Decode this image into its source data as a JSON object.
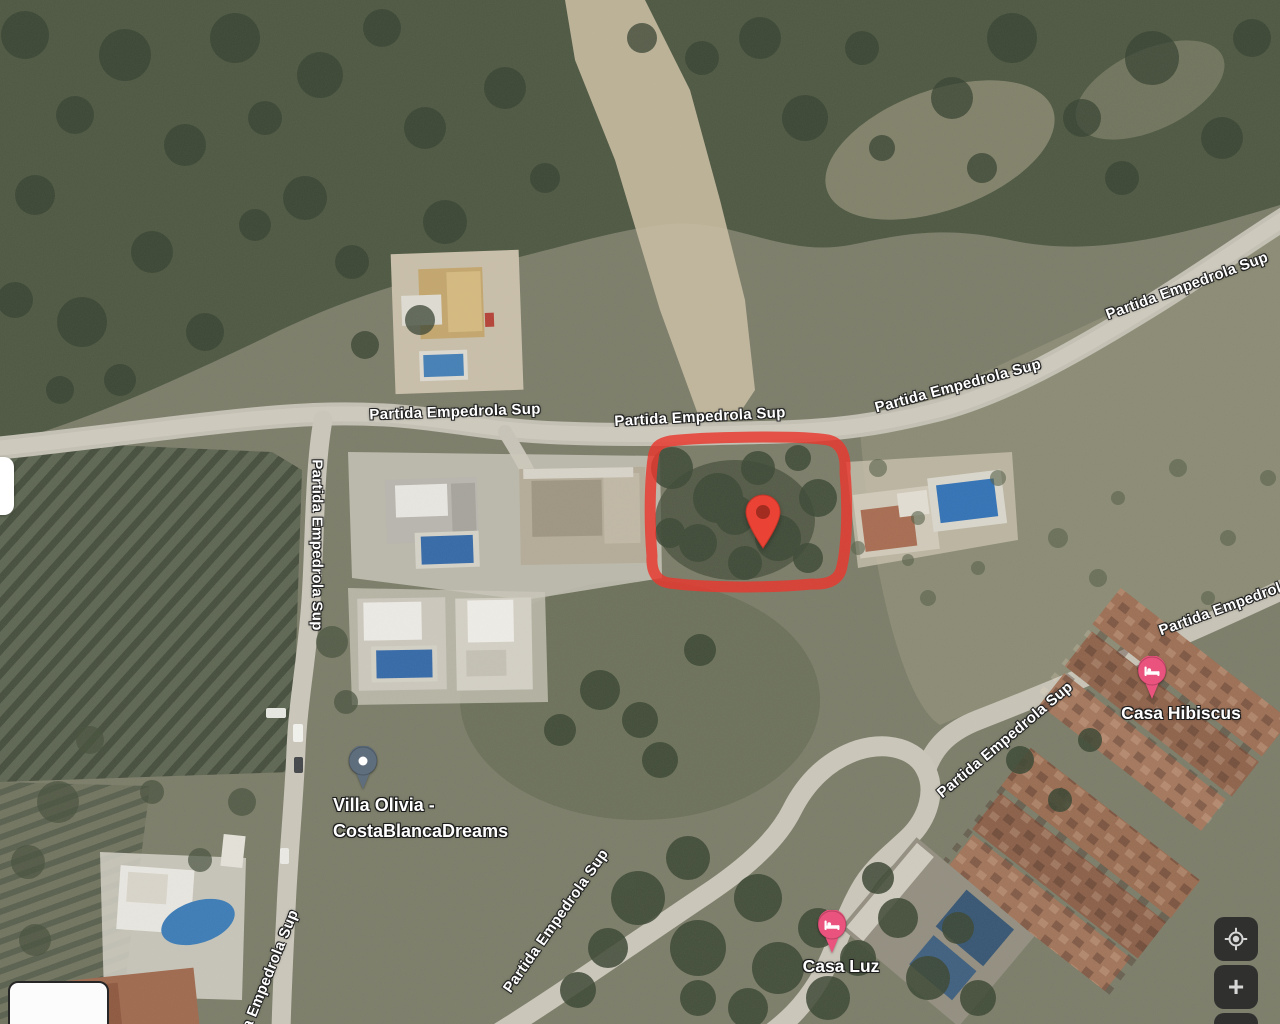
{
  "map": {
    "street_name": "Partida Empedrola Sup",
    "places": {
      "villa_olivia": {
        "line1": "Villa Olivia -",
        "line2": "CostaBlancaDreams"
      },
      "casa_hibiscus": {
        "name": "Casa Hibiscus"
      },
      "casa_luz": {
        "name": "Casa Luz"
      }
    },
    "controls": {
      "zoom_in_label": "+",
      "zoom_out_label": "−"
    },
    "icons": {
      "my_location": "crosshair-target",
      "lodging_pin": "bed",
      "generic_poi_pin": "dot"
    },
    "colors": {
      "selected_marker": "#EA4335",
      "selected_marker_hole": "#A32C20",
      "plot_outline": "#E8392F",
      "lodging_pin": "#E9537D",
      "generic_poi_pin": "#5F6E7D",
      "control_background": "#282828",
      "control_icon": "#D6D6D6",
      "label_text": "#FFFFFF"
    }
  }
}
